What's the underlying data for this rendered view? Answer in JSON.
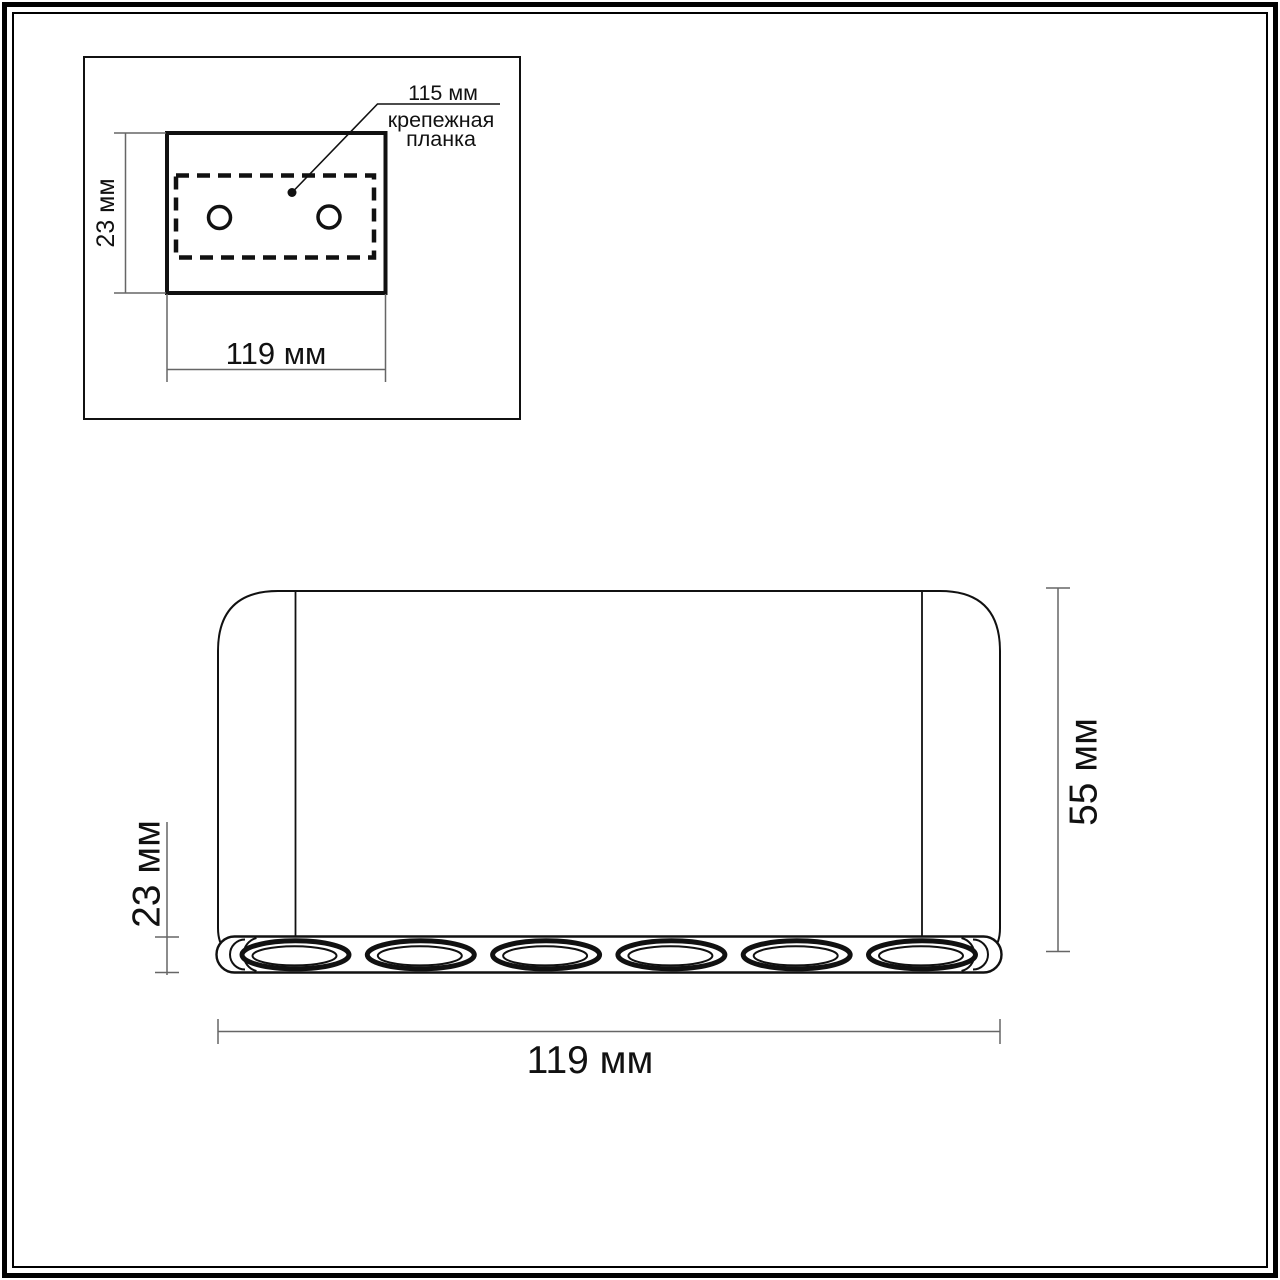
{
  "inset": {
    "plate_width_label": "115 мм",
    "plate_name_line1": "крепежная",
    "plate_name_line2": "планка",
    "height_label": "23 мм",
    "width_label": "119 мм"
  },
  "main": {
    "led_section_height_label": "23 мм",
    "height_label": "55 мм",
    "width_label": "119 мм",
    "lights_count": 6
  },
  "colors": {
    "line": "#111111",
    "dim_line": "#666666",
    "background": "#ffffff"
  }
}
